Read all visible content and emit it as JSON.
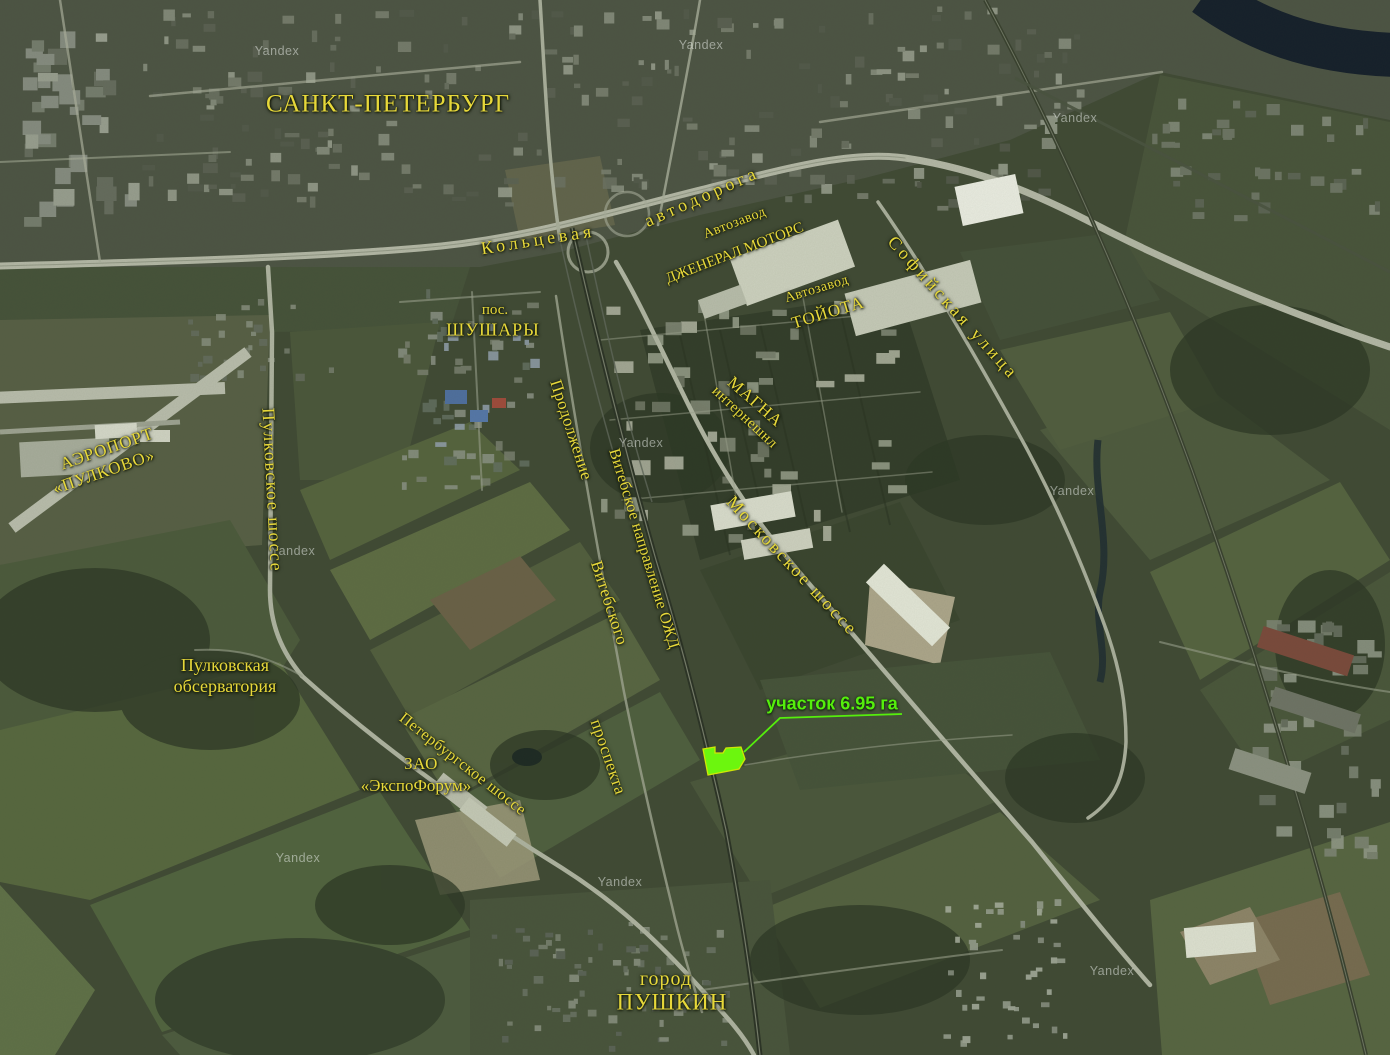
{
  "map": {
    "colors": {
      "label_yellow": "#e7d83a",
      "site_green": "#55ee0c",
      "site_fill": "#6cf60e",
      "site_stroke": "#cfe606",
      "watermark_white": "#f0f4f0"
    },
    "labels": [
      {
        "name": "city-saint-petersburg",
        "lines": [
          "САНКТ-ПЕТЕРБУРГ"
        ],
        "x": 388,
        "y": 104,
        "rot": 0,
        "size": 25,
        "ls": 1
      },
      {
        "name": "ring-road-koltsevaya",
        "lines": [
          "Кольцевая"
        ],
        "x": 538,
        "y": 240,
        "rot": -9,
        "size": 18,
        "ls": 4
      },
      {
        "name": "ring-road-avtodoroga",
        "lines": [
          "автодорога"
        ],
        "x": 702,
        "y": 197,
        "rot": -24,
        "size": 18,
        "ls": 4
      },
      {
        "name": "gm-plant-avtozavod",
        "lines": [
          "Автозавод"
        ],
        "x": 735,
        "y": 224,
        "rot": -21,
        "size": 14,
        "ls": 0.5
      },
      {
        "name": "gm-plant-general-motors",
        "lines": [
          "ДЖЕНЕРАЛ МОТОРС"
        ],
        "x": 735,
        "y": 254,
        "rot": -21,
        "size": 15,
        "ls": 0
      },
      {
        "name": "toyota-plant-avtozavod",
        "lines": [
          "Автозавод"
        ],
        "x": 817,
        "y": 290,
        "rot": -17,
        "size": 14,
        "ls": 0.5
      },
      {
        "name": "toyota-plant-toyota",
        "lines": [
          "ТОЙОТА"
        ],
        "x": 828,
        "y": 313,
        "rot": -17,
        "size": 17,
        "ls": 1
      },
      {
        "name": "sofiyskaya-ulitsa",
        "lines": [
          "Софийская улица"
        ],
        "x": 953,
        "y": 308,
        "rot": 48,
        "size": 18,
        "ls": 3.5
      },
      {
        "name": "shushary-pos",
        "lines": [
          "пос."
        ],
        "x": 495,
        "y": 311,
        "rot": 0,
        "size": 15,
        "ls": 0
      },
      {
        "name": "shushary",
        "lines": [
          "ШУШАРЫ"
        ],
        "x": 493,
        "y": 330,
        "rot": 0,
        "size": 18,
        "ls": 1
      },
      {
        "name": "magna",
        "lines": [
          "МАГНА"
        ],
        "x": 755,
        "y": 402,
        "rot": 41,
        "size": 17,
        "ls": 1
      },
      {
        "name": "magna-international",
        "lines": [
          "интернешнл"
        ],
        "x": 744,
        "y": 418,
        "rot": 43,
        "size": 15,
        "ls": 0.5
      },
      {
        "name": "airport-aeroport",
        "lines": [
          "АЭРОПОРТ"
        ],
        "x": 107,
        "y": 449,
        "rot": -19,
        "size": 17,
        "ls": 1
      },
      {
        "name": "airport-pulkovo",
        "lines": [
          "«ПУЛКОВО»"
        ],
        "x": 104,
        "y": 472,
        "rot": -19,
        "size": 17,
        "ls": 1
      },
      {
        "name": "pulkovskoe-shosse",
        "lines": [
          "Пулковское шоссе"
        ],
        "x": 272,
        "y": 490,
        "rot": 87,
        "size": 18,
        "ls": 1.5
      },
      {
        "name": "prodolzhenie",
        "lines": [
          "Продолжение"
        ],
        "x": 571,
        "y": 430,
        "rot": 72,
        "size": 17,
        "ls": 0.5
      },
      {
        "name": "vitebskogo",
        "lines": [
          "Витебского"
        ],
        "x": 609,
        "y": 603,
        "rot": 72,
        "size": 17,
        "ls": 0.5
      },
      {
        "name": "prospekta",
        "lines": [
          "проспекта"
        ],
        "x": 608,
        "y": 757,
        "rot": 71,
        "size": 17,
        "ls": 0.5
      },
      {
        "name": "vitebsk-railway",
        "lines": [
          "Витебское направление ОЖД"
        ],
        "x": 643,
        "y": 549,
        "rot": 73,
        "size": 16,
        "ls": 0.3
      },
      {
        "name": "moskovskoe-shosse",
        "lines": [
          "Московское шоссе"
        ],
        "x": 792,
        "y": 566,
        "rot": 47,
        "size": 18,
        "ls": 2.5
      },
      {
        "name": "pulkovo-observatory",
        "lines": [
          "Пулковская",
          "обсерватория"
        ],
        "x": 225,
        "y": 676,
        "rot": 0,
        "size": 18,
        "ls": 0
      },
      {
        "name": "expoforum-zao",
        "lines": [
          "ЗАО"
        ],
        "x": 421,
        "y": 764,
        "rot": 0,
        "size": 17,
        "ls": 0.5
      },
      {
        "name": "expoforum",
        "lines": [
          "«ЭкспоФорум»"
        ],
        "x": 416,
        "y": 786,
        "rot": 0,
        "size": 17,
        "ls": 0
      },
      {
        "name": "peterburgskoe-shosse",
        "lines": [
          "Петербургское шоссе"
        ],
        "x": 462,
        "y": 765,
        "rot": 38,
        "size": 16,
        "ls": 0.5
      },
      {
        "name": "pushkin-gorod",
        "lines": [
          "город"
        ],
        "x": 666,
        "y": 980,
        "rot": 0,
        "size": 20,
        "ls": 1
      },
      {
        "name": "pushkin",
        "lines": [
          "ПУШКИН"
        ],
        "x": 672,
        "y": 1002,
        "rot": 0,
        "size": 23,
        "ls": 1
      }
    ],
    "site": {
      "label": "участок 6.95 га",
      "area_ha": "6.95",
      "label_x": 832,
      "label_y": 704,
      "font_size": 18,
      "polygon_points": "703,749 715,747 715,753 723,753 726,748 741,747 745,759 739,769 708,775",
      "leader_points": "902,714 780,718 744,752"
    },
    "watermarks": {
      "text": "Yandex",
      "positions": [
        [
          277,
          51
        ],
        [
          701,
          45
        ],
        [
          1075,
          118
        ],
        [
          641,
          443
        ],
        [
          293,
          551
        ],
        [
          1072,
          491
        ],
        [
          298,
          858
        ],
        [
          620,
          882
        ],
        [
          1112,
          971
        ]
      ]
    }
  }
}
